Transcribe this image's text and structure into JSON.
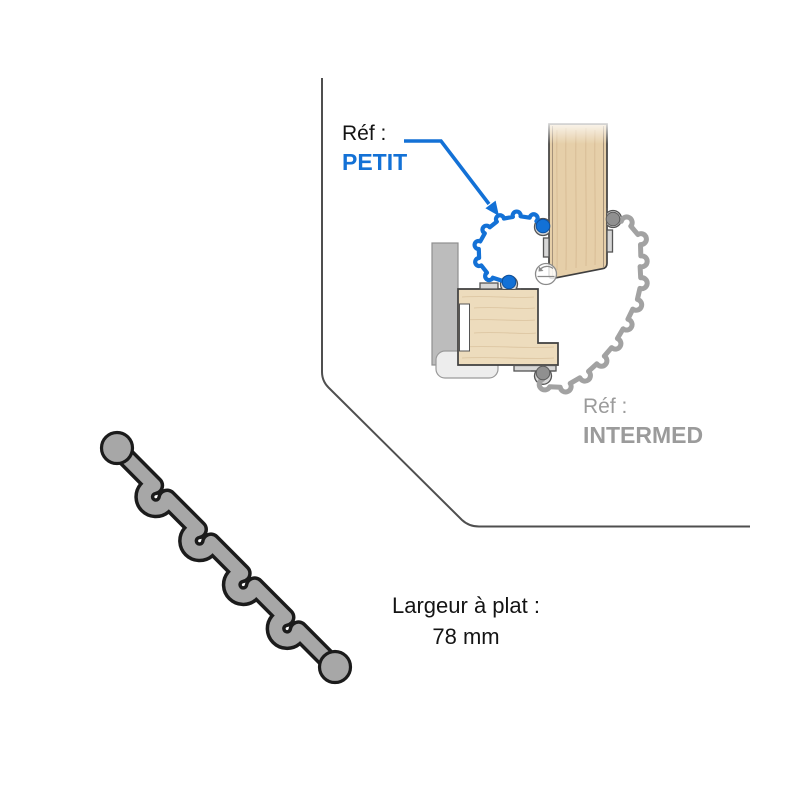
{
  "diagram": {
    "seal_petit": {
      "ref_label": "Réf :",
      "name": "PETIT"
    },
    "seal_intermed": {
      "ref_label": "Réf :",
      "name": "INTERMED"
    },
    "flat_width": {
      "label": "Largeur à plat :",
      "value": "78 mm"
    }
  },
  "colors": {
    "petit_accent": "#1371d6",
    "intermed_gray": "#9b9b9b",
    "profile_gray": "#a7a7a7"
  }
}
